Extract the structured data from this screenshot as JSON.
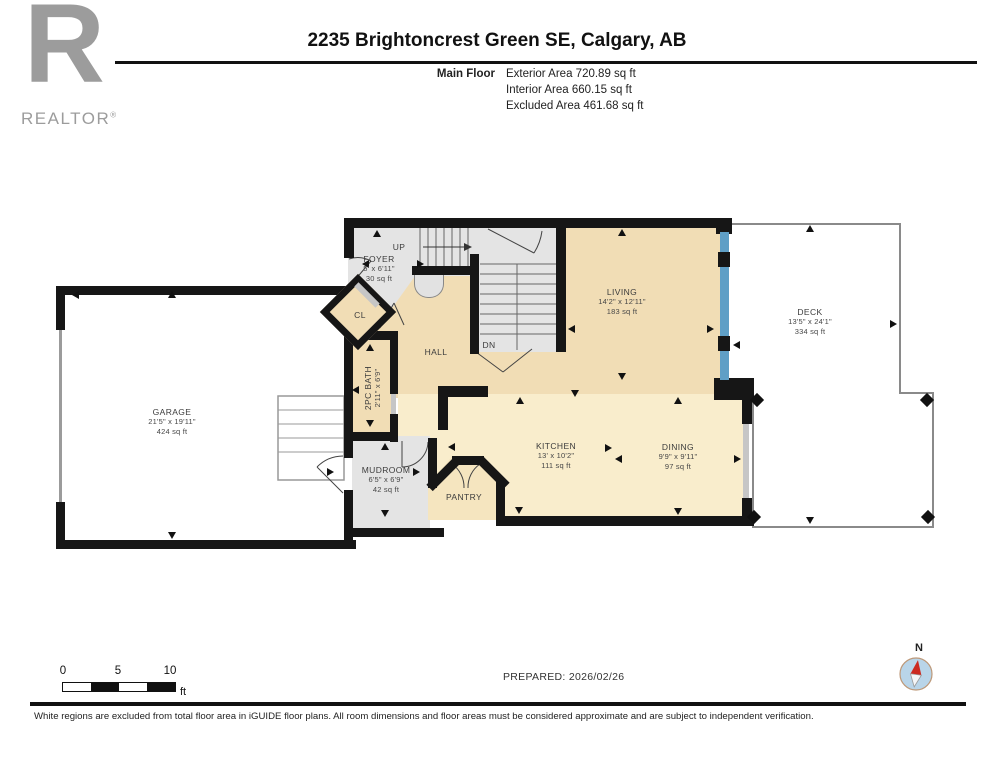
{
  "header": {
    "logo": {
      "letter": "R",
      "brand": "REALTOR",
      "registered": "®"
    },
    "title": "2235 Brightoncrest Green SE, Calgary, AB",
    "floor_label": "Main Floor",
    "area_lines": [
      "Exterior Area 720.89 sq ft",
      "Interior Area 660.15 sq ft",
      "Excluded Area 461.68 sq ft"
    ]
  },
  "rooms": {
    "foyer": {
      "name": "FOYER",
      "dims": "5' x 6'11\"",
      "area": "30 sq ft"
    },
    "stairs_up": {
      "name": "UP"
    },
    "stairs_dn": {
      "name": "DN"
    },
    "closet": {
      "name": "CL"
    },
    "hall": {
      "name": "HALL"
    },
    "living": {
      "name": "LIVING",
      "dims": "14'2\" x 12'11\"",
      "area": "183 sq ft"
    },
    "deck": {
      "name": "DECK",
      "dims": "13'5\" x 24'1\"",
      "area": "334 sq ft"
    },
    "garage": {
      "name": "GARAGE",
      "dims": "21'5\" x 19'11\"",
      "area": "424 sq ft"
    },
    "bath": {
      "name": "2PC BATH",
      "dims": "2'11\" x 6'9\""
    },
    "mudroom": {
      "name": "MUDROOM",
      "dims": "6'5\" x 6'9\"",
      "area": "42 sq ft"
    },
    "pantry": {
      "name": "PANTRY"
    },
    "kitchen": {
      "name": "KITCHEN",
      "dims": "13' x 10'2\"",
      "area": "111 sq ft"
    },
    "dining": {
      "name": "DINING",
      "dims": "9'9\" x 9'11\"",
      "area": "97 sq ft"
    }
  },
  "scale_bar": {
    "tick0": "0",
    "tick5": "5",
    "tick10": "10",
    "unit": "ft"
  },
  "footer": {
    "prepared": "PREPARED: 2026/02/26",
    "disclaimer": "White regions are excluded from total floor area in iGUIDE floor plans. All room dimensions and floor areas must be considered approximate and are subject to independent verification.",
    "compass_n": "N"
  },
  "colors": {
    "interior_fill": "#f1ddb5",
    "kitchen_fill": "#f9edcc",
    "excluded_fill": "#e4e4e4",
    "wall": "#161616",
    "window_blue": "#5f9fc6",
    "logo_gray": "#9c9c9c"
  }
}
